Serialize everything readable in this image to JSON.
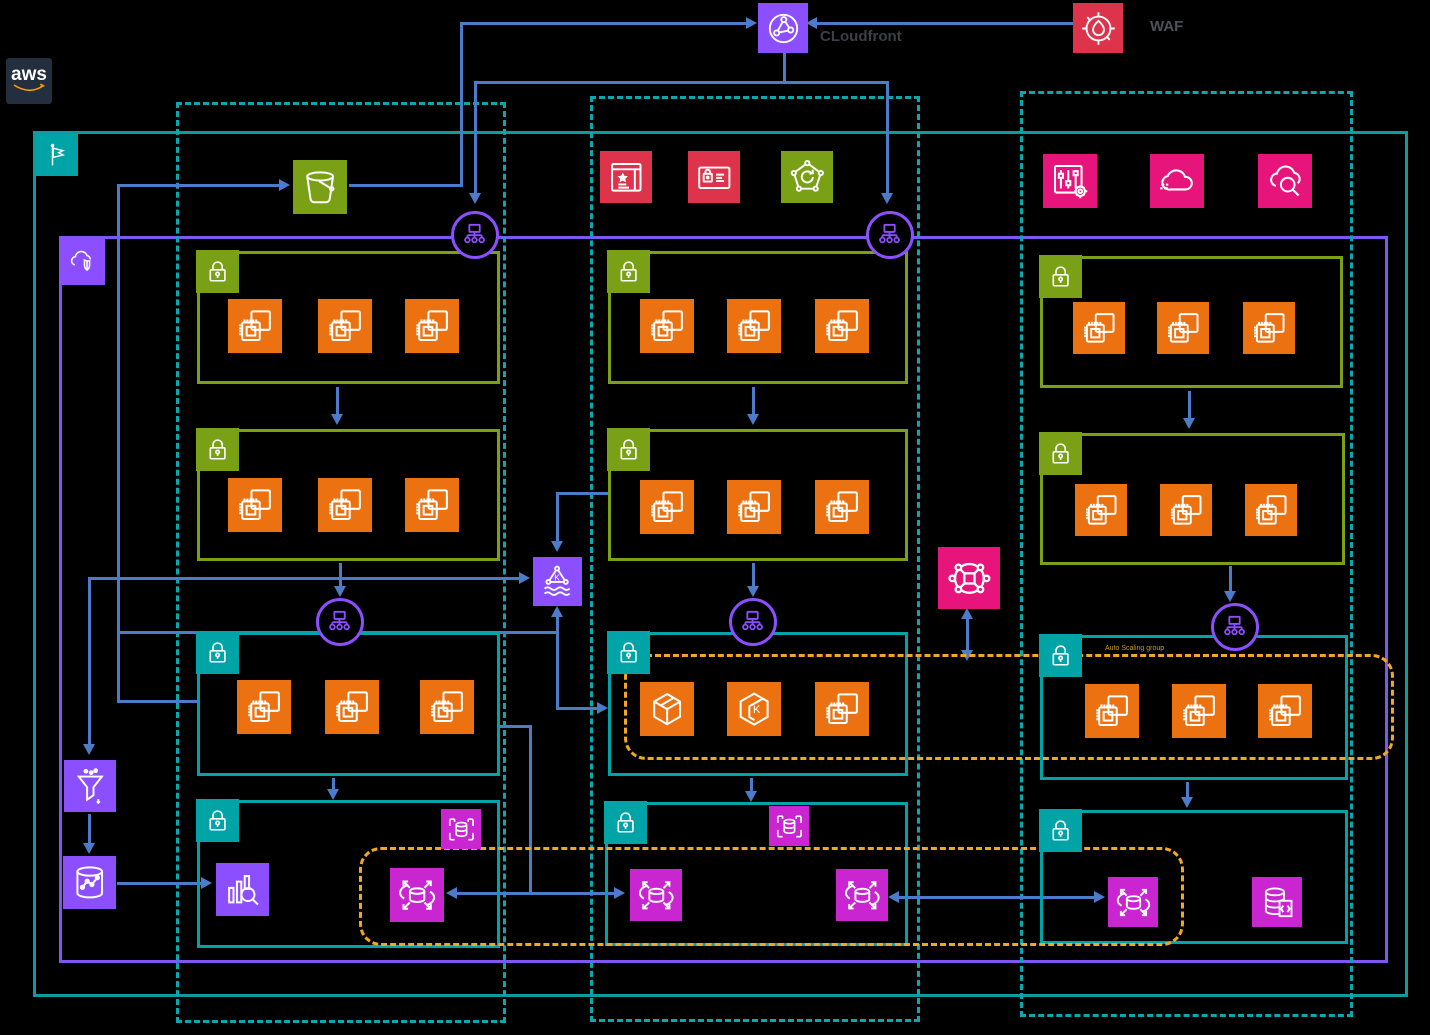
{
  "labels": {
    "aws_logo": "aws",
    "cloudfront": "CLoudfront",
    "waf": "WAF",
    "auto_scaling_group": "Auto Scaling group"
  },
  "colors": {
    "background": "#000000",
    "region_border": "#0d9b9b",
    "availability_zone_border": "#0ba7af",
    "vpc_border": "#8155f4",
    "security_group_green": "#7aa116",
    "subnet_teal": "#00a4a6",
    "compute_orange": "#ec7211",
    "networking_purple": "#8c4fff",
    "management_pink": "#e7157b",
    "database_magenta": "#c925d1",
    "security_red": "#dd344c",
    "flow_line_blue": "#4b7bc9",
    "auto_scaling_dash": "#f0a824",
    "aws_logo_bg": "#232f3e",
    "aws_smile": "#ff9900"
  },
  "icons": {
    "waf-icon": "flame in crosshair circle",
    "cloudfront-icon": "globe with connected nodes",
    "s3-bucket-icon": "bucket",
    "flag-icon": "pennant flag on pole",
    "vpc-shield-icon": "cloud with shield",
    "browser-star-icon": "browser window with star",
    "id-card-lock-icon": "card with padlock and lines",
    "pentagon-deploy-icon": "pentagon with vertex nodes and circular arrow",
    "systems-manager-icon": "sliders with gear",
    "cloud-fast-icon": "cloud with speed dashes",
    "cloud-search-icon": "cloud with magnifier",
    "security-group-lock-icon": "padlock badge",
    "ec2-instance-icon": "chip with stacked squares",
    "load-balancer-icon": "monitor over three nodes in circle",
    "msk-icon": "triangle K over waves",
    "transit-gateway-icon": "square hub with orbit nodes",
    "kinesis-firehose-icon": "funnel with drops",
    "analytics-db-icon": "cylinder with trend line",
    "opensearch-icon": "bar chart with magnifier",
    "rds-proxy-icon": "database cylinder in brackets",
    "global-database-icon": "database cylinder with orbit and outward arrows",
    "database-script-icon": "database cylinder with code document",
    "container-icon": "3d cube",
    "eks-icon": "hexagon with K"
  },
  "architecture": {
    "edge_services": [
      "waf",
      "cloudfront"
    ],
    "shared_service_icons_zone2": [
      "browser-star",
      "id-card-lock",
      "pentagon-deploy"
    ],
    "ops_icons_zone3": [
      "systems-manager",
      "cloud-fast",
      "cloud-search"
    ],
    "availability_zones": 3,
    "tiers_per_zone": [
      {
        "tier": "web",
        "boundary": "security-group",
        "instances": 3
      },
      {
        "tier": "app",
        "boundary": "security-group",
        "instances": 3
      },
      {
        "tier": "service",
        "boundary": "subnet",
        "instances": 3,
        "in_auto_scaling_group": true
      },
      {
        "tier": "data",
        "boundary": "subnet"
      }
    ],
    "data_flow": [
      "msk",
      "kinesis-firehose",
      "analytics-db",
      "opensearch"
    ],
    "database_row": [
      "rds-proxy",
      "global-database",
      "database-script"
    ],
    "inter_zone": "transit-gateway"
  }
}
